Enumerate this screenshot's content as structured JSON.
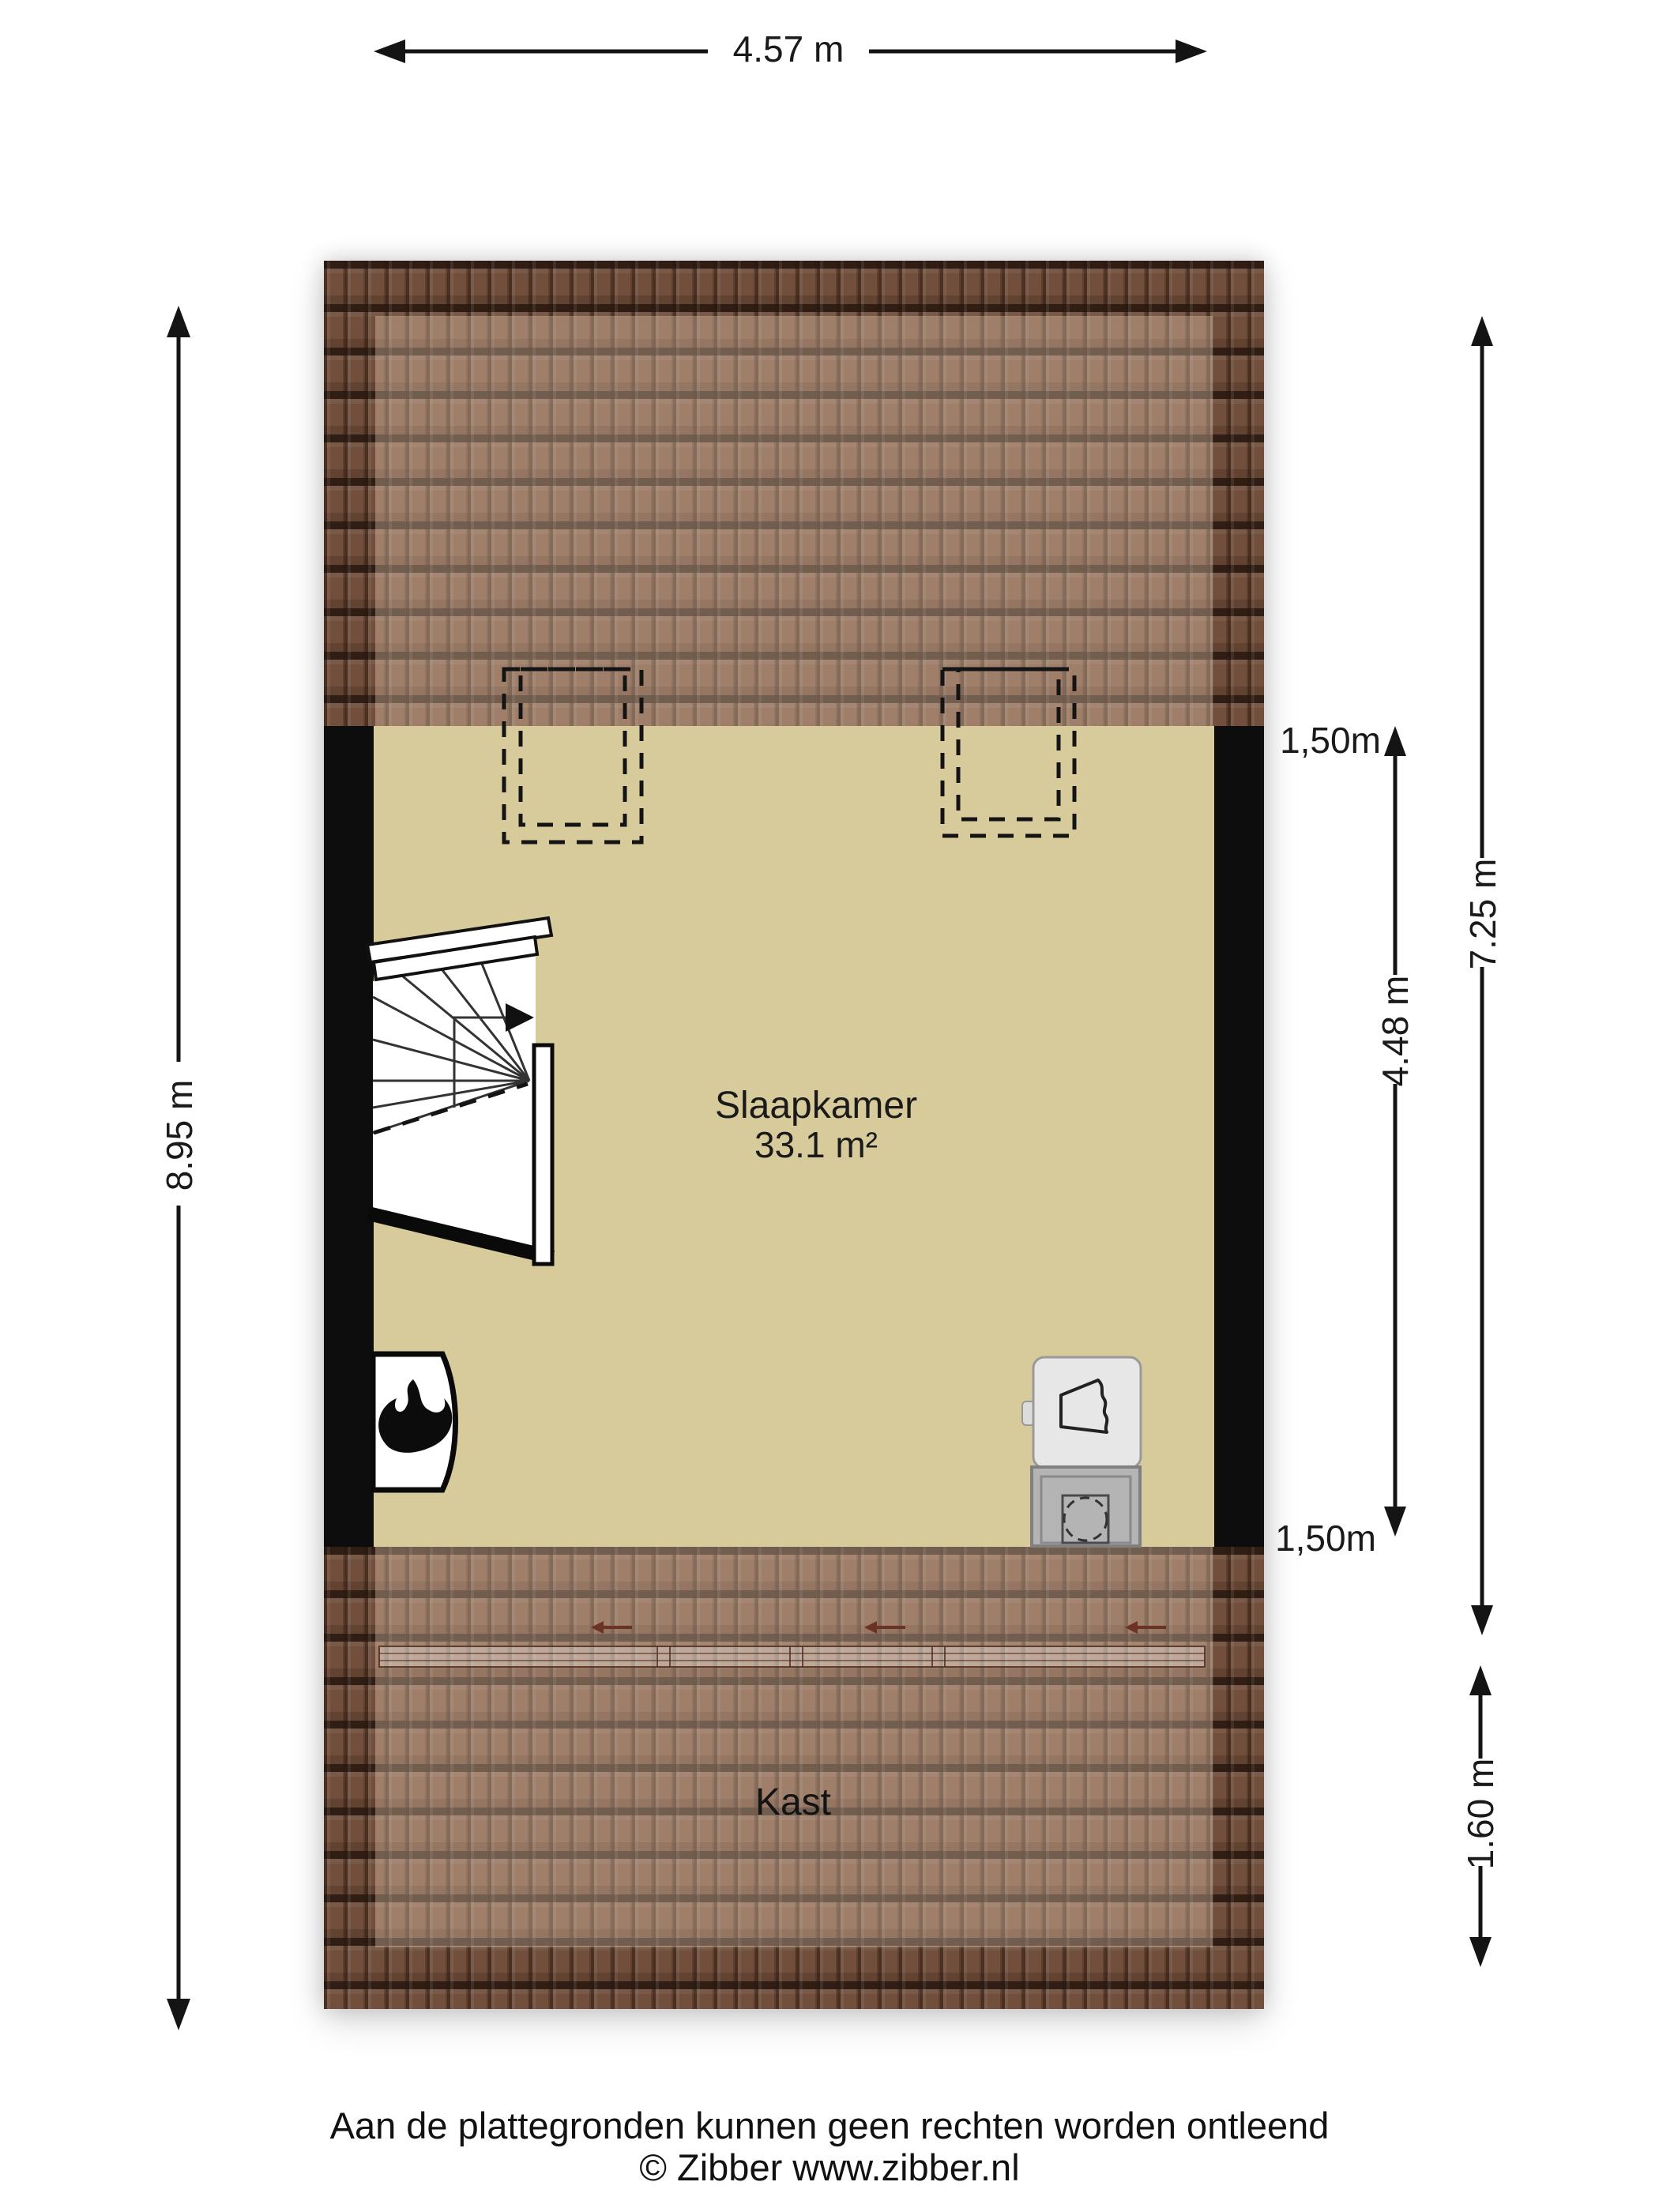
{
  "floorplan": {
    "rooms": {
      "bedroom": {
        "name": "Slaapkamer",
        "area": "33.1 m²"
      },
      "closet": {
        "name": "Kast"
      }
    },
    "dimensions": {
      "width_top": "4.57 m",
      "height_left": "8.95 m",
      "right_outer_height": "7.25 m",
      "right_inner_height": "4.48 m",
      "right_bottom_height": "1.60 m",
      "headroom_line_top": "1,50m",
      "headroom_line_bottom": "1,50m"
    },
    "colors": {
      "background": "#ffffff",
      "floor": "#d8cb9b",
      "roof_tile": "#9a6e55",
      "wall": "#0d0d0d",
      "line": "#141414",
      "slide_arrow": "#6b3226"
    },
    "icons": {
      "heater": "flame-icon",
      "sink": "sink-icon",
      "washer": "washing-machine-icon",
      "stairs": "stairs-direction-arrow-icon",
      "closet_doors": "sliding-door-arrow-icon"
    }
  },
  "footer": {
    "disclaimer": "Aan de plattegronden kunnen geen rechten worden ontleend",
    "copyright": "© Zibber www.zibber.nl"
  }
}
